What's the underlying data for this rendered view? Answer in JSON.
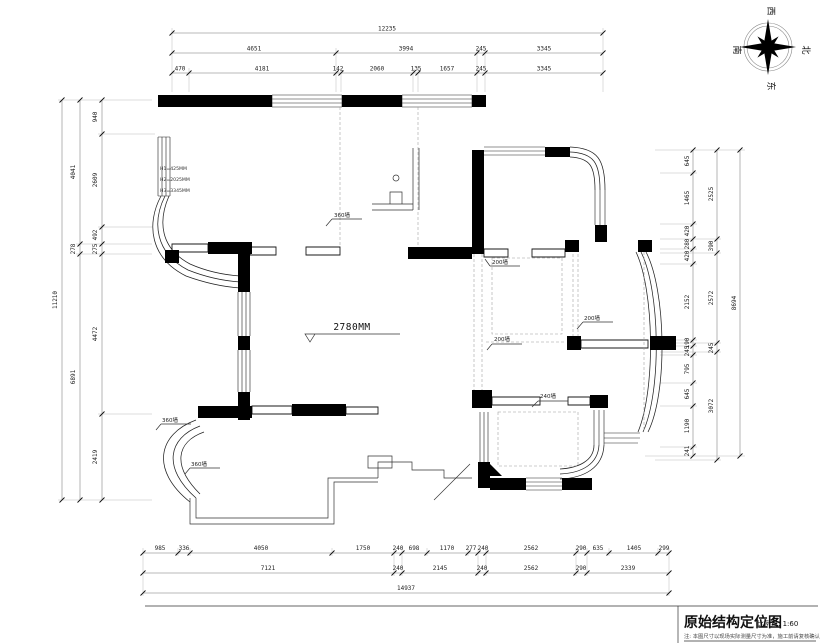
{
  "compass": {
    "top": "西",
    "right": "北",
    "bottom": "东",
    "left": "南"
  },
  "dims": {
    "top": {
      "total": "12235",
      "row2": [
        "4651",
        "3994",
        "245",
        "3345"
      ],
      "row3": [
        "470",
        "4181",
        "142",
        "2060",
        "135",
        "1657",
        "245",
        "3345"
      ]
    },
    "left": {
      "total": "11210",
      "middle": [
        "4041",
        "278",
        "6891"
      ],
      "inner": [
        "940",
        "2609",
        "492",
        "275",
        "4472",
        "2419"
      ]
    },
    "right": {
      "total": "8694",
      "middle": [
        "2525",
        "390",
        "2572",
        "245",
        "3072"
      ],
      "inner": [
        "645",
        "1465",
        "420",
        "280",
        "420",
        "2152",
        "190",
        "245",
        "795",
        "645",
        "1190",
        "241"
      ]
    },
    "bottom": {
      "total": "14937",
      "row1": [
        "985",
        "336",
        "4050",
        "1750",
        "240",
        "698",
        "1170",
        "277",
        "240",
        "2562",
        "290",
        "635",
        "1405",
        "299"
      ],
      "row2": [
        "7121",
        "240",
        "2145",
        "240",
        "2562",
        "290",
        "2339"
      ]
    }
  },
  "plan_labels": {
    "ceiling_height": "2780MM",
    "wall_360_top": "360墙",
    "wall_360_left_upper": "360墙",
    "wall_360_left_lower": "360墙",
    "wall_200_a": "200墙",
    "wall_200_b": "200墙",
    "wall_200_c": "200墙",
    "wall_240": "240墙",
    "height_note_1": "H1=425MM",
    "height_note_2": "H2=2025MM",
    "height_note_3": "H3=3345MM"
  },
  "titleblock": {
    "title": "原始结构定位图",
    "scale": "比例尺: 1:60",
    "note": "注: 本图尺寸以现场实际测量尺寸为准，施工前请复核确认。"
  }
}
